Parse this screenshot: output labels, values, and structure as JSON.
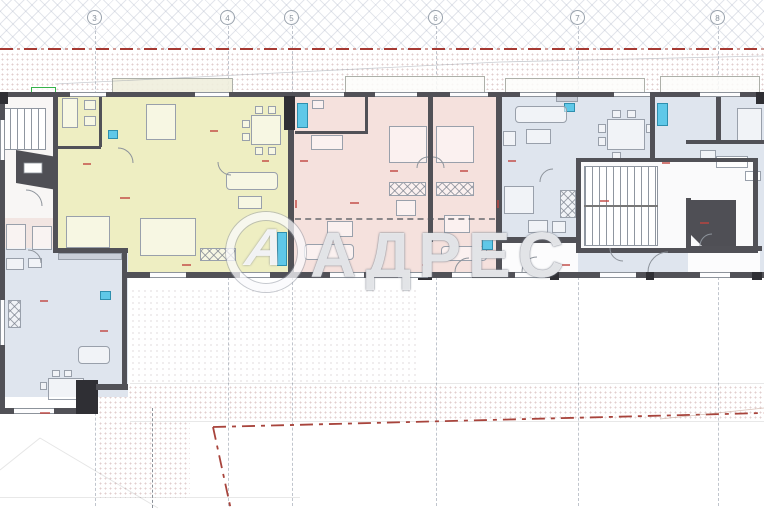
{
  "watermark": {
    "brand": "АДРЕС",
    "logo_letter": "А"
  },
  "grid_markers": [
    "3",
    "4",
    "5",
    "6",
    "7",
    "8"
  ],
  "colors": {
    "unit_yellow": "#eeeec2",
    "unit_pink": "#f5e1dd",
    "unit_blue": "#dfe5ee",
    "core_white": "#f8f6f5",
    "core_pink": "#f2e5e2",
    "wall": "#515157",
    "wall_dark": "#2f2f34",
    "datum_red": "#a63a33",
    "boundary_red": "#a8443c",
    "fixture_cyan": "#5fc8e8",
    "marker_green": "#35b24a",
    "dim_red": "#c0453f"
  }
}
